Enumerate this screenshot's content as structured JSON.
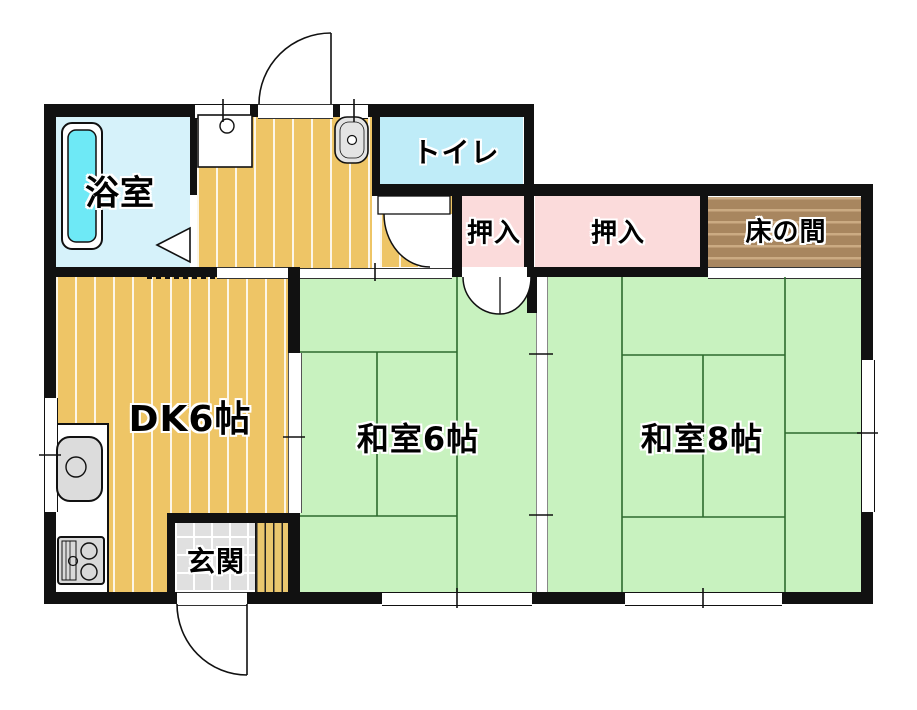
{
  "plan": {
    "rooms": {
      "bathroom": {
        "label": "浴室"
      },
      "toilet": {
        "label": "トイレ"
      },
      "closet1": {
        "label": "押入"
      },
      "closet2": {
        "label": "押入"
      },
      "tokonoma": {
        "label": "床の間"
      },
      "dining_kitchen": {
        "label": "DK6帖"
      },
      "japanese_room_6": {
        "label": "和室6帖"
      },
      "japanese_room_8": {
        "label": "和室8帖"
      },
      "entrance": {
        "label": "玄関"
      }
    },
    "colors": {
      "wall": "#111111",
      "bathroom": "#d6f2fa",
      "toilet": "#bfecf8",
      "bathtub": "#6ee9f6",
      "closet": "#fbdbdb",
      "tokonoma": "#a8865f",
      "flooring": "#eec566",
      "tatami": "#c8f2bf",
      "tatami_line": "#2e6b2e",
      "entrance_tile": "#e0e0e0"
    },
    "fixtures": [
      "bathtub",
      "washbasin",
      "hand-wash-basin",
      "kitchen-sink",
      "gas-stove",
      "hinged-door",
      "sliding-door",
      "double-closet-door",
      "folding-bath-door",
      "window"
    ]
  }
}
